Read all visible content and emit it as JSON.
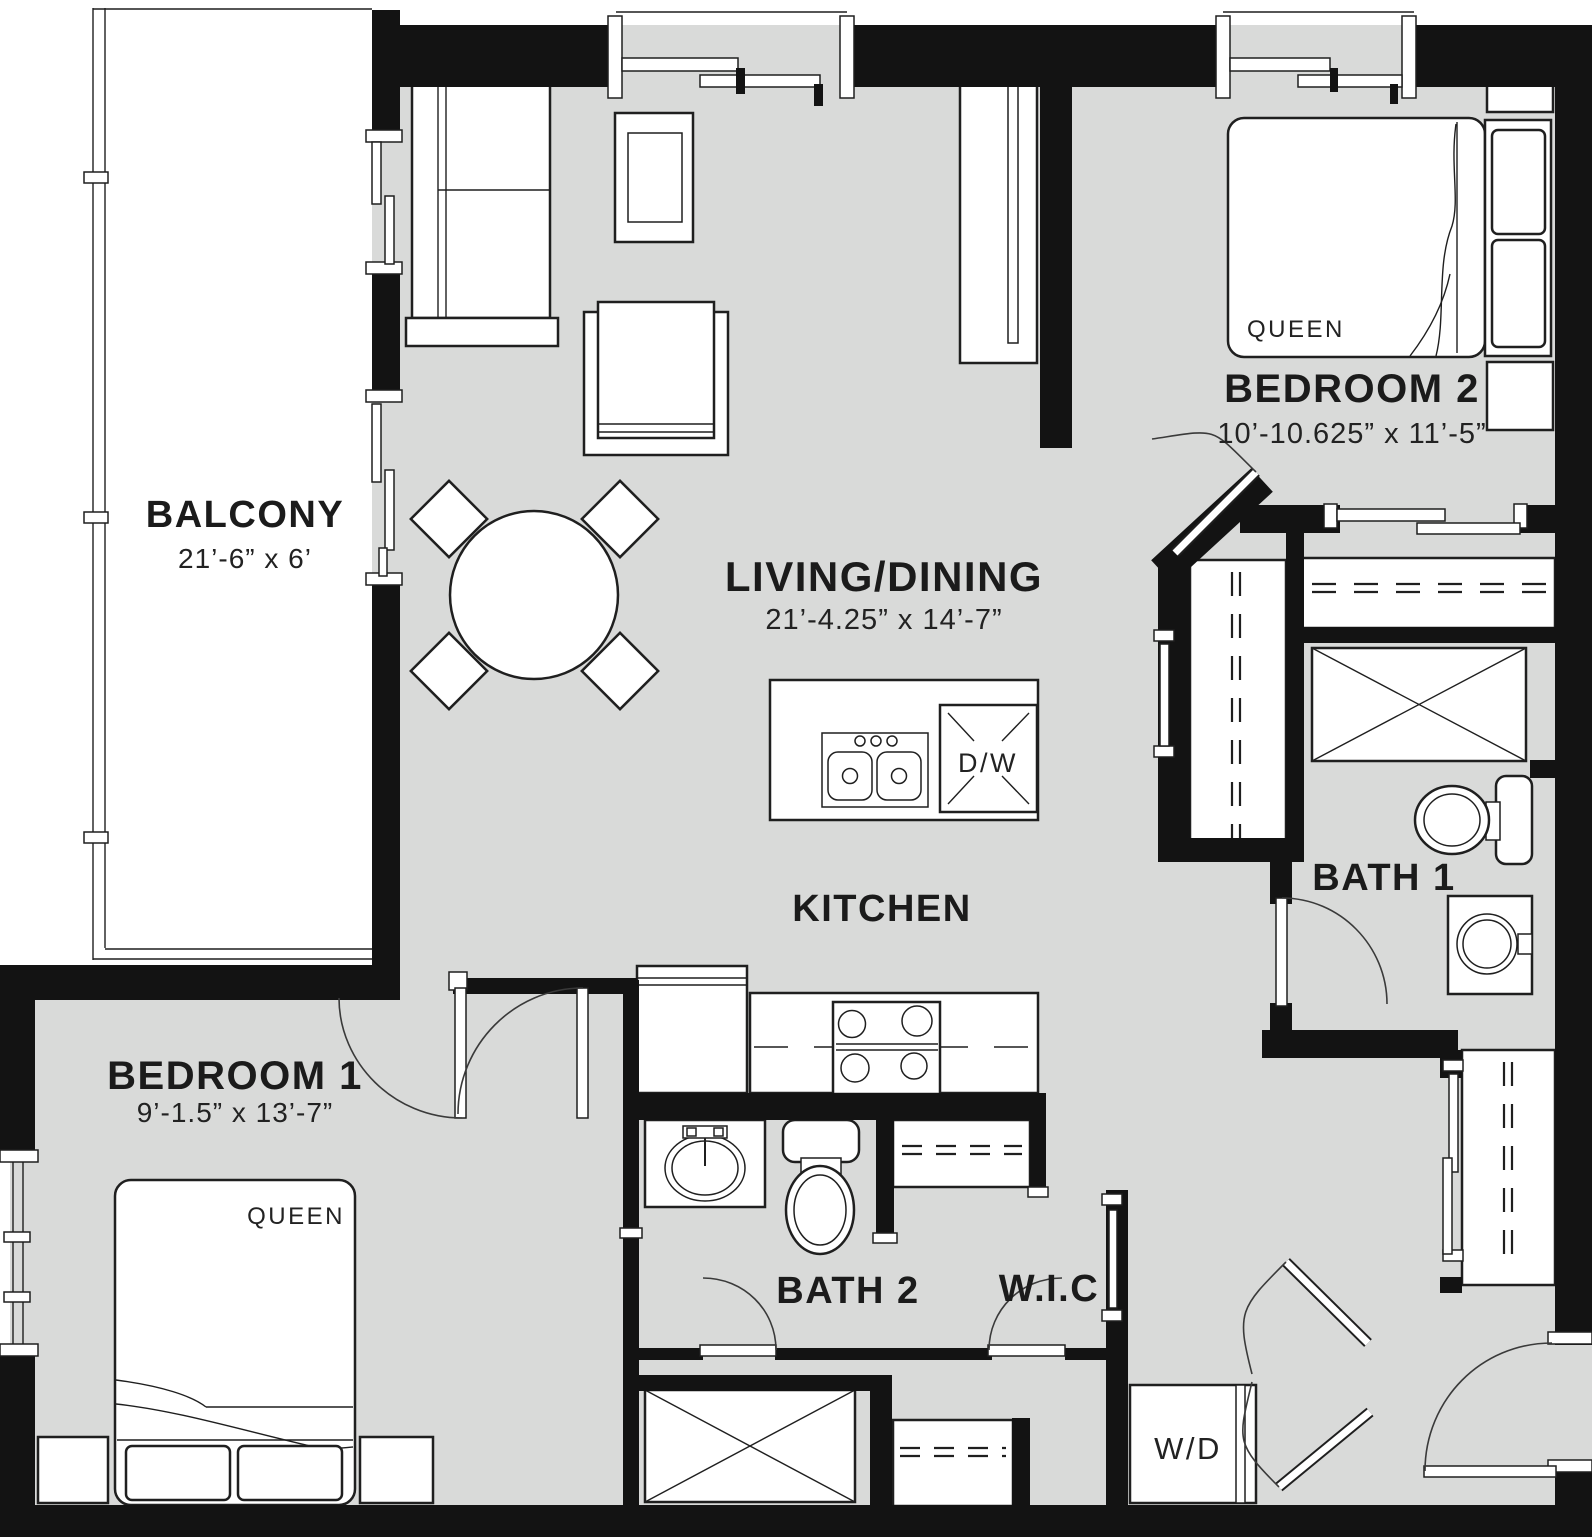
{
  "rooms": {
    "balcony": {
      "name": "BALCONY",
      "dims": "21’-6” x 6’"
    },
    "living": {
      "name": "LIVING/DINING",
      "dims": "21’-4.25” x 14’-7”"
    },
    "kitchen": {
      "name": "KITCHEN"
    },
    "bedroom2": {
      "name": "BEDROOM 2",
      "dims": "10’-10.625” x 11’-5”"
    },
    "bedroom1": {
      "name": "BEDROOM 1",
      "dims": "9’-1.5” x 13’-7”"
    },
    "bath1": {
      "name": "BATH 1"
    },
    "bath2": {
      "name": "BATH 2"
    },
    "wic": {
      "name": "W.I.C"
    }
  },
  "fixtures": {
    "bed1": "QUEEN",
    "bed2": "QUEEN",
    "washer_dryer": "W/D",
    "dishwasher": "D/W"
  },
  "colors": {
    "floor": "#d9dad9",
    "wall": "#131313",
    "line": "#1f1f1f",
    "background": "#ffffff"
  }
}
